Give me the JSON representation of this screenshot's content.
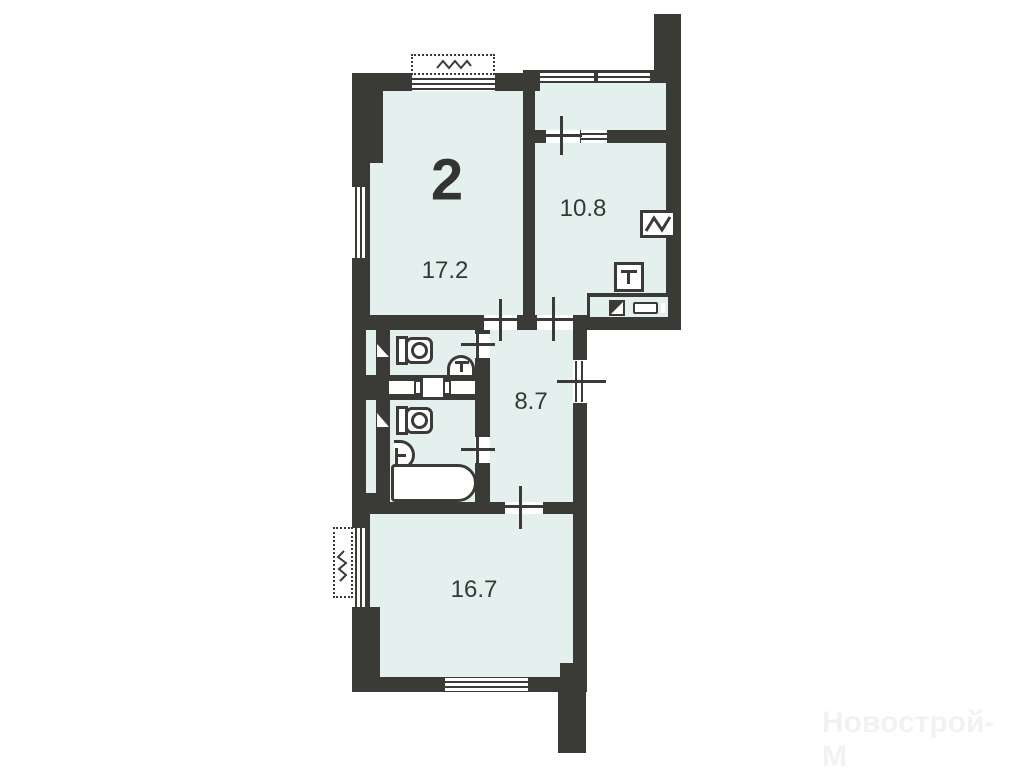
{
  "plan": {
    "type_label": "2",
    "rooms": [
      {
        "id": "living-room",
        "area": "17.2"
      },
      {
        "id": "kitchen",
        "area": "10.8"
      },
      {
        "id": "hallway",
        "area": "8.7"
      },
      {
        "id": "bedroom",
        "area": "16.7"
      }
    ],
    "icons": [
      "toilet-icon",
      "washbasin-icon",
      "bathtub-icon",
      "stove-icon",
      "sink-icon",
      "vent-shaft-icon",
      "cabinet-icon",
      "window",
      "door-cross-marker",
      "ac-unit"
    ],
    "colors": {
      "wall": "#3a3a37",
      "floor_fill": "#e3f0ee",
      "background": "#ffffff",
      "label": "#373737",
      "watermark": "#f2f2f2"
    }
  },
  "watermark": {
    "text": "Новострой-М"
  }
}
